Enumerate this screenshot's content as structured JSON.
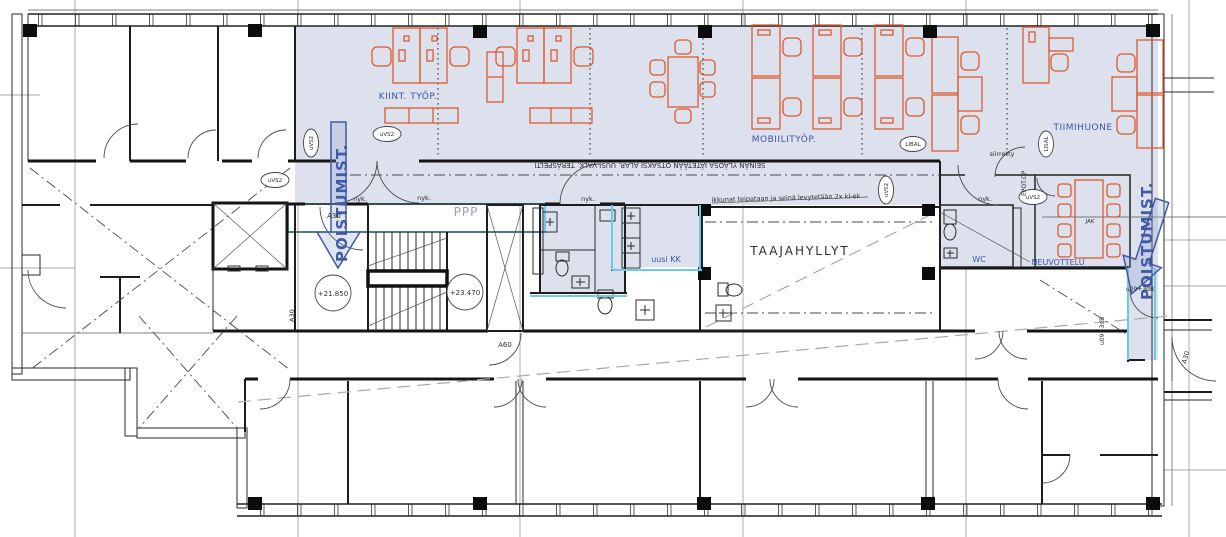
{
  "plan": {
    "rooms": {
      "kiint_tyop": "KIINT. TYÖP.",
      "mobiilityop": "MOBIILITYÖP.",
      "tiimihuone": "TIIMIHUONE",
      "taajahyllyt": "TAAJAHYLLYT",
      "neuvottelu": "NEUVOTTELU",
      "wc": "WC",
      "uusi_kk": "uusi KK"
    },
    "exit": {
      "poistumist": "POISTUMIST."
    },
    "levels": {
      "left": "+21.850",
      "right": "+23.470"
    },
    "doors": {
      "a30": "A30",
      "a60": "A60",
      "u09": "u09+3dB",
      "epot": "EPOT.OP"
    },
    "tags": {
      "uvs2": "uVS2",
      "libal": "LIBAL",
      "lisal": "LISÄL",
      "jak": "JAK",
      "nyk": "nyk.",
      "ppp": "PPP",
      "siirretty": "siirretty"
    },
    "notes": {
      "top_rotated": "SEINÄN YLÄOSA JÄTETÄÄN OTSAKSI ALAR. UUSI VALK. TERÄSPELTI",
      "windows": "ikkunat teipataan ja seinä levytetään 2x kl-ek"
    },
    "colors": {
      "area_fill": "#dce1ed",
      "furniture": "#dd5a2c",
      "label_blue": "#3c55a5",
      "highlight_cyan": "#6cc9e9",
      "wall": "#1d1d1d"
    }
  }
}
